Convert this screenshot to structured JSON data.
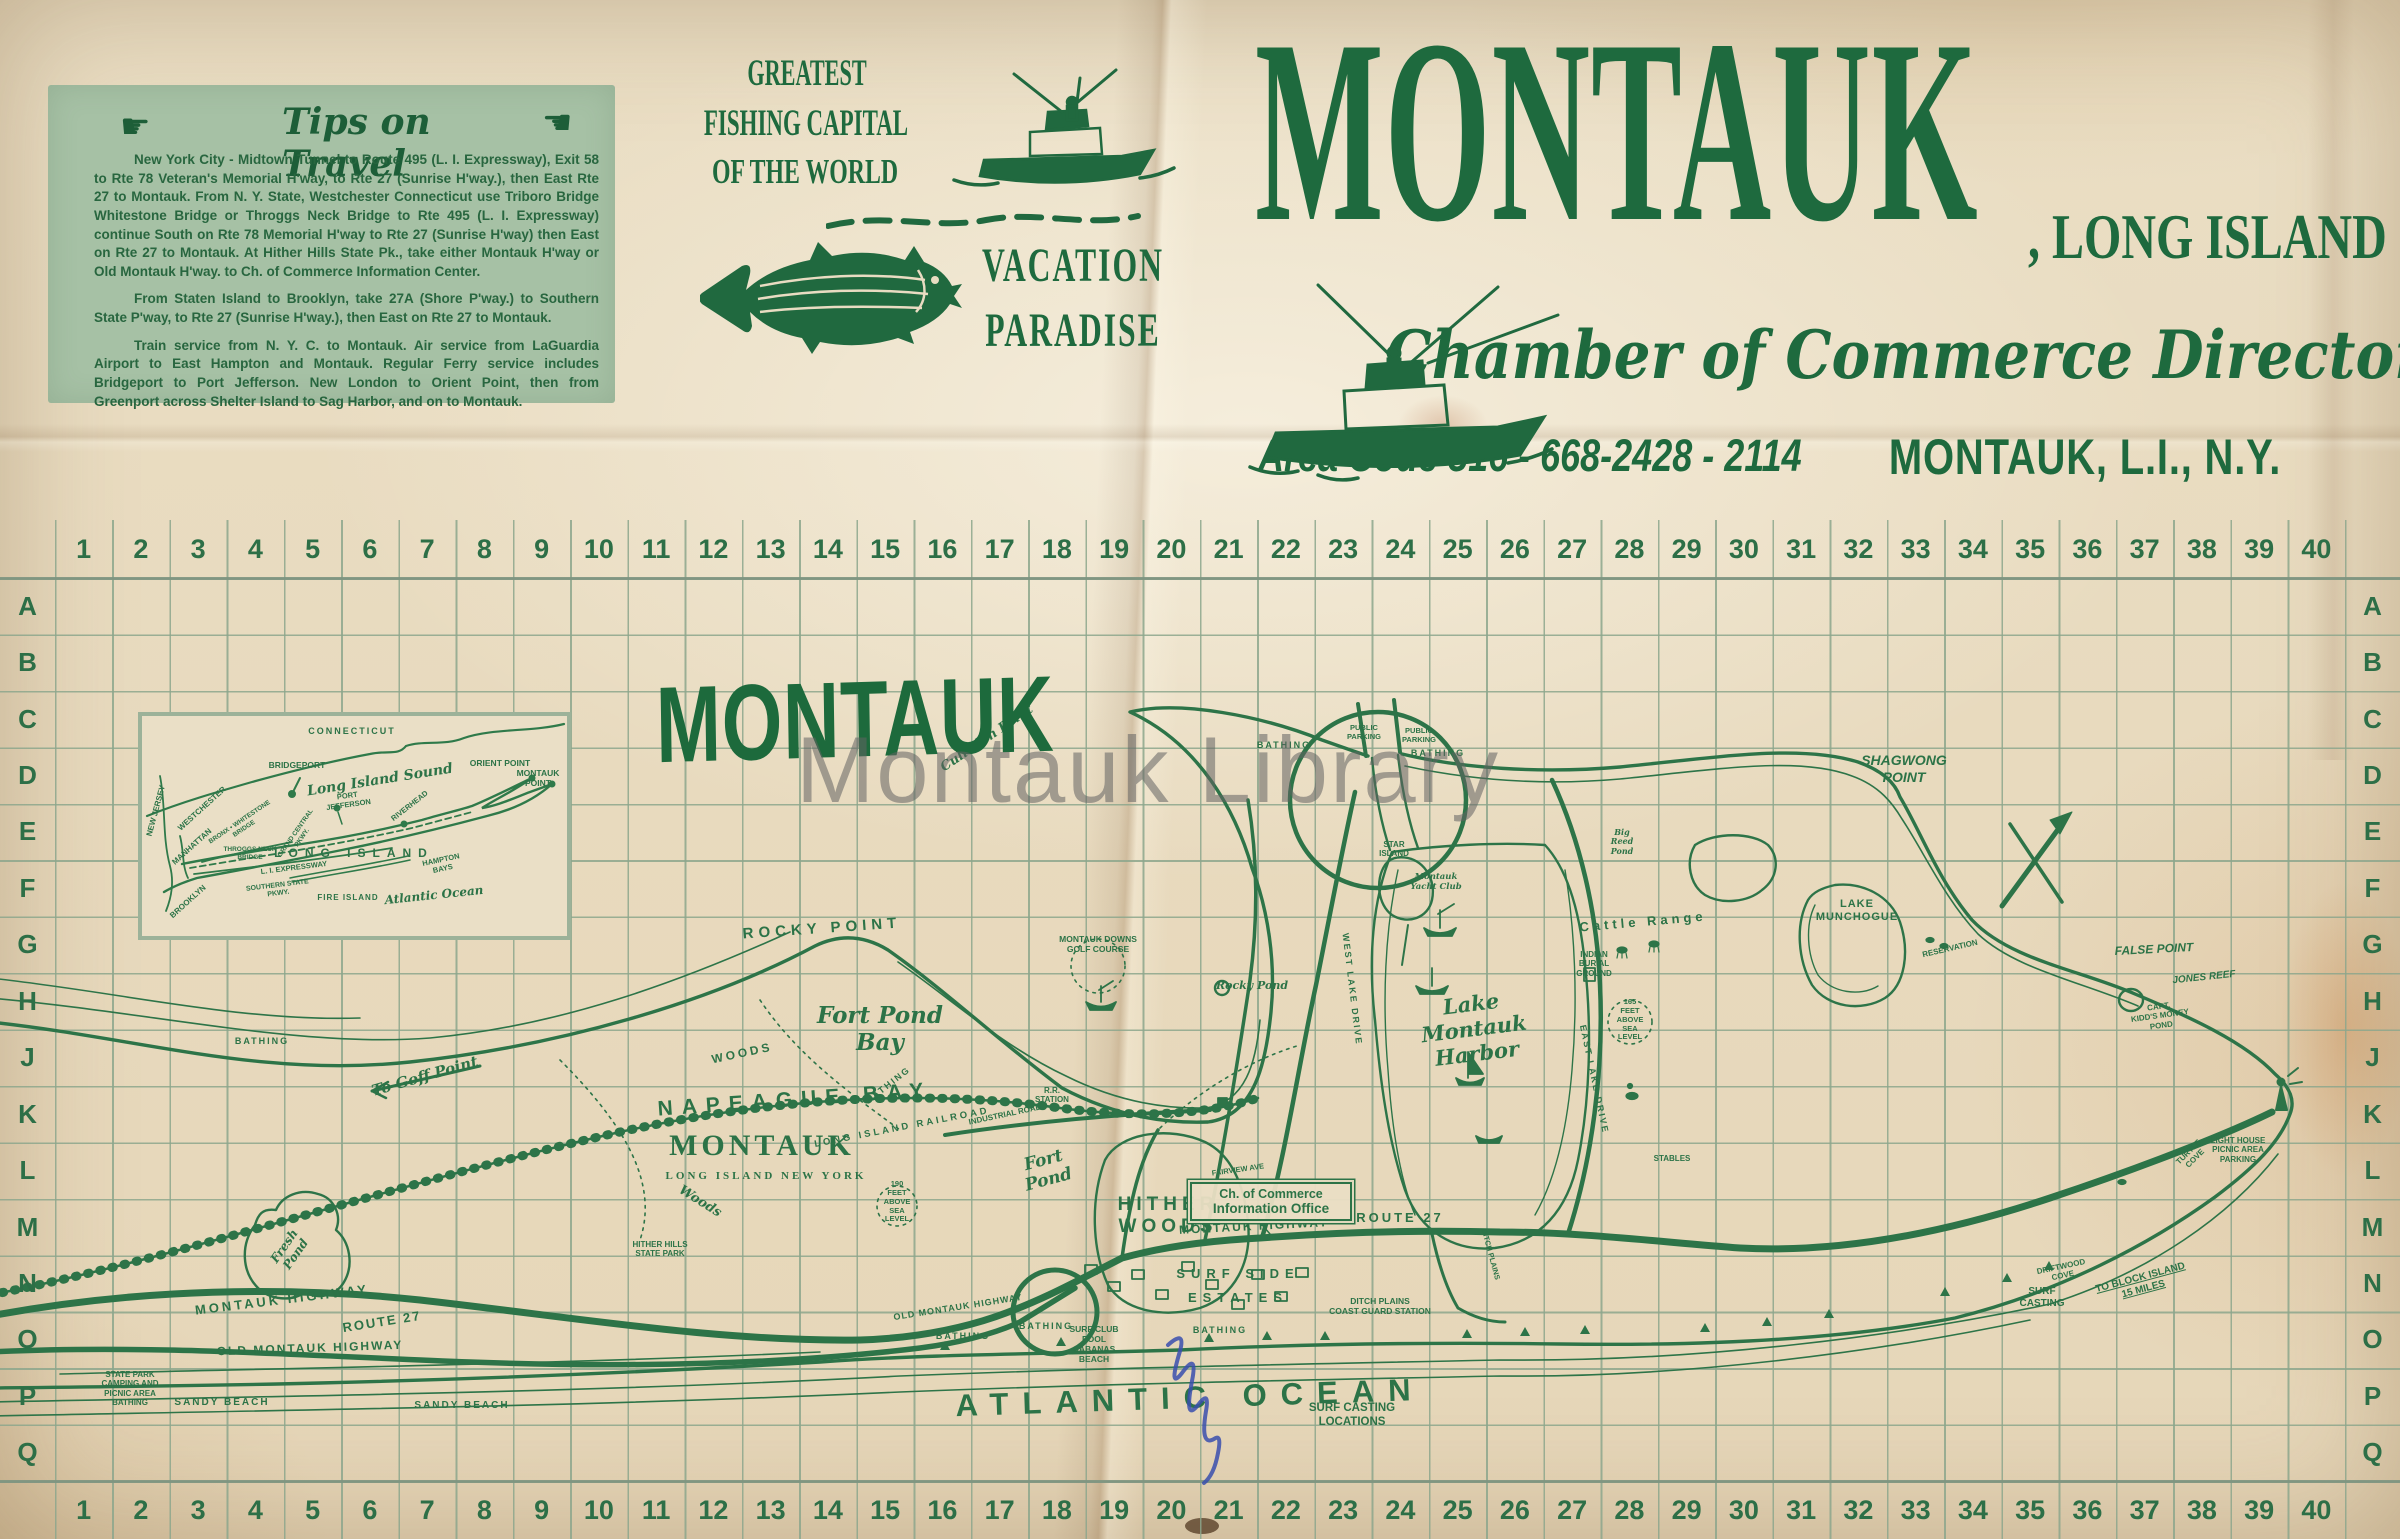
{
  "paper": {
    "watermark": "Montauk Library"
  },
  "tips_box": {
    "heading": "Tips on Travel",
    "hand_right": "☛",
    "hand_left": "☚",
    "paragraphs": [
      "New York City - Midtown Tunnel to Route 495 (L. I. Expressway), Exit 58 to Rte 78 Veteran's Memorial H'way, to Rte 27 (Sunrise H'way.), then East Rte 27 to Montauk. From N. Y. State, Westchester Connecticut use Triboro Bridge  Whitestone Bridge or Throggs Neck Bridge to Rte 495 (L. I. Expressway)  continue South on Rte 78 Memorial H'way to Rte 27 (Sunrise H'way) then East on Rte 27 to Montauk. At Hither Hills State Pk., take either Montauk H'way or Old Montauk H'way. to Ch. of Commerce Information Center.",
      "From Staten Island to Brooklyn, take 27A (Shore P'way.) to Southern State P'way, to Rte 27 (Sunrise H'way.), then East on Rte 27 to Montauk.",
      "Train service from N. Y. C. to Montauk. Air service from LaGuardia Airport to East Hampton and Montauk. Regular Ferry service includes Bridgeport to Port Jefferson. New London to Orient Point, then from Greenport across Shelter Island to Sag Harbor, and on to Montauk."
    ]
  },
  "banner": {
    "line1": "GREATEST",
    "line2": "FISHING CAPITAL",
    "line3": "OF THE WORLD",
    "vacation1": "VACATION",
    "vacation2": "PARADISE"
  },
  "masthead": {
    "title": "MONTAUK",
    "suffix": ", LONG ISLAND",
    "script_line": "Chamber of Commerce Directory",
    "location": "MONTAUK, L.I., N.Y.",
    "phone": "Area Code 516 - 668-2428 - 2114"
  },
  "grid": {
    "columns": [
      "1",
      "2",
      "3",
      "4",
      "5",
      "6",
      "7",
      "8",
      "9",
      "10",
      "11",
      "12",
      "13",
      "14",
      "15",
      "16",
      "17",
      "18",
      "19",
      "20",
      "21",
      "22",
      "23",
      "24",
      "25",
      "26",
      "27",
      "28",
      "29",
      "30",
      "31",
      "32",
      "33",
      "34",
      "35",
      "36",
      "37",
      "38",
      "39",
      "40"
    ],
    "rows": [
      "A",
      "B",
      "C",
      "D",
      "E",
      "F",
      "G",
      "H",
      "J",
      "K",
      "L",
      "M",
      "N",
      "O",
      "P",
      "Q"
    ]
  },
  "map": {
    "title": "MONTAUK",
    "office_line1": "Ch. of Commerce",
    "office_line2": "Information Office",
    "labels": [
      {
        "t": "NAPEAGUE BAY",
        "x": 795,
        "y": 1088,
        "fs": 21,
        "ls": 9,
        "rot": -4
      },
      {
        "t": "To Goff Point",
        "x": 425,
        "y": 1068,
        "fs": 15,
        "rot": -16,
        "cls": "script"
      },
      {
        "t": "Fresh\nPond",
        "x": 290,
        "y": 1236,
        "fs": 12,
        "rot": -55,
        "cls": "script"
      },
      {
        "t": "LONG ISLAND RAILROAD",
        "x": 902,
        "y": 1122,
        "fs": 9.5,
        "ls": 3,
        "rot": -11
      },
      {
        "t": "HITHER\nWOODS",
        "x": 1168,
        "y": 1194,
        "fs": 19,
        "ls": 5
      },
      {
        "t": "HITHER HILLS\nSTATE PARK",
        "x": 660,
        "y": 1240,
        "fs": 8
      },
      {
        "t": "ROCKY POINT",
        "x": 822,
        "y": 920,
        "fs": 15,
        "ls": 5,
        "rot": -4
      },
      {
        "t": "Rocky Pond",
        "x": 1252,
        "y": 980,
        "fs": 11,
        "cls": "script"
      },
      {
        "t": "Fort Pond\nBay",
        "x": 880,
        "y": 1002,
        "fs": 23,
        "cls": "script"
      },
      {
        "t": "WOODS",
        "x": 742,
        "y": 1046,
        "fs": 12,
        "ls": 3,
        "rot": -12
      },
      {
        "t": "Woods",
        "x": 700,
        "y": 1194,
        "fs": 13,
        "rot": 32,
        "cls": "script"
      },
      {
        "t": "MONTAUK HIGHWAY",
        "x": 282,
        "y": 1292,
        "fs": 13,
        "ls": 3,
        "rot": -7
      },
      {
        "t": "ROUTE 27",
        "x": 382,
        "y": 1314,
        "fs": 13,
        "ls": 2,
        "rot": -9
      },
      {
        "t": "OLD MONTAUK HIGHWAY",
        "x": 310,
        "y": 1341,
        "fs": 12,
        "ls": 2,
        "rot": -2
      },
      {
        "t": "OLD MONTAUK HIGHWAY",
        "x": 958,
        "y": 1302,
        "fs": 9,
        "ls": 1,
        "rot": -9
      },
      {
        "t": "STATE PARK\nCAMPING AND\nPICNIC AREA\nBATHING",
        "x": 130,
        "y": 1370,
        "fs": 8
      },
      {
        "t": "SANDY BEACH",
        "x": 222,
        "y": 1397,
        "fs": 10,
        "ls": 2
      },
      {
        "t": "SANDY BEACH",
        "x": 462,
        "y": 1400,
        "fs": 10,
        "ls": 2
      },
      {
        "t": "ATLANTIC OCEAN",
        "x": 1190,
        "y": 1380,
        "fs": 31,
        "ls": 14,
        "rot": -2
      },
      {
        "t": "BATHING",
        "x": 963,
        "y": 1331,
        "fs": 9,
        "ls": 2
      },
      {
        "t": "BATHING",
        "x": 1046,
        "y": 1321,
        "fs": 9,
        "ls": 2
      },
      {
        "t": "BATHING",
        "x": 1220,
        "y": 1325,
        "fs": 9,
        "ls": 2
      },
      {
        "t": "BATHING",
        "x": 888,
        "y": 1080,
        "fs": 9,
        "ls": 2,
        "rot": -38
      },
      {
        "t": "BATHING",
        "x": 1284,
        "y": 740,
        "fs": 9,
        "ls": 2
      },
      {
        "t": "BATHING",
        "x": 1438,
        "y": 748,
        "fs": 9,
        "ls": 2
      },
      {
        "t": "BATHING",
        "x": 262,
        "y": 1036,
        "fs": 9,
        "ls": 2
      },
      {
        "t": "SURF CLUB\nPOOL\nCABANAS\nBEACH",
        "x": 1094,
        "y": 1324,
        "fs": 8.5
      },
      {
        "t": "SURF SIDE",
        "x": 1238,
        "y": 1266,
        "fs": 13,
        "ls": 6
      },
      {
        "t": "ESTATES",
        "x": 1238,
        "y": 1290,
        "fs": 13,
        "ls": 6
      },
      {
        "t": "DITCH PLAINS\nCOAST GUARD STATION",
        "x": 1380,
        "y": 1296,
        "fs": 8.5
      },
      {
        "t": "SURF CASTING\nLOCATIONS",
        "x": 1352,
        "y": 1402,
        "fs": 11.5
      },
      {
        "t": "Fort\nPond",
        "x": 1046,
        "y": 1150,
        "fs": 17,
        "rot": -15,
        "cls": "script"
      },
      {
        "t": "Lake\nMontauk\nHarbor",
        "x": 1474,
        "y": 992,
        "fs": 21,
        "rot": -7,
        "cls": "script"
      },
      {
        "t": "Cattle Range",
        "x": 1643,
        "y": 914,
        "fs": 13,
        "ls": 4,
        "rot": -5
      },
      {
        "t": "INDIAN\nBURIAL\nGROUND",
        "x": 1594,
        "y": 950,
        "fs": 8
      },
      {
        "t": "165\nFEET\nABOVE\nSEA\nLEVEL",
        "x": 1630,
        "y": 998,
        "fs": 7.5
      },
      {
        "t": "190\nFEET\nABOVE\nSEA\nLEVEL",
        "x": 897,
        "y": 1180,
        "fs": 7.5
      },
      {
        "t": "STABLES",
        "x": 1672,
        "y": 1154,
        "fs": 8
      },
      {
        "t": "R.R.\n STATION",
        "x": 1052,
        "y": 1086,
        "fs": 8
      },
      {
        "t": "STAR\nISLAND",
        "x": 1394,
        "y": 840,
        "fs": 8
      },
      {
        "t": "Montauk\nYacht Club",
        "x": 1436,
        "y": 872,
        "fs": 8.5,
        "cls": "script"
      },
      {
        "t": "PUBLIC\nPARKING",
        "x": 1364,
        "y": 724,
        "fs": 7.5
      },
      {
        "t": "PUBLIC\nPARKING",
        "x": 1419,
        "y": 727,
        "fs": 7.5
      },
      {
        "t": "Culloden Point",
        "x": 987,
        "y": 731,
        "fs": 13,
        "rot": -34,
        "cls": "script"
      },
      {
        "t": "SHAGWONG\nPOINT",
        "x": 1904,
        "y": 752,
        "fs": 14,
        "cls": "it"
      },
      {
        "t": "LAKE\nMUNCHOGUE",
        "x": 1857,
        "y": 898,
        "fs": 11,
        "ls": 1
      },
      {
        "t": "RESERVATION",
        "x": 1950,
        "y": 944,
        "fs": 8,
        "rot": -13
      },
      {
        "t": "FALSE POINT",
        "x": 2154,
        "y": 942,
        "fs": 12,
        "rot": -3,
        "cls": "it"
      },
      {
        "t": "JONES REEF",
        "x": 2204,
        "y": 972,
        "fs": 10,
        "rot": -6,
        "cls": "it"
      },
      {
        "t": "CAPT.\nKIDD'S MONEY\nPOND",
        "x": 2160,
        "y": 1002,
        "fs": 8,
        "rot": -8
      },
      {
        "t": "LIGHT HOUSE\nPICNIC AREA\nPARKING",
        "x": 2238,
        "y": 1136,
        "fs": 8
      },
      {
        "t": "TURTLE\nCOVE",
        "x": 2192,
        "y": 1146,
        "fs": 8,
        "rot": -45
      },
      {
        "t": "DRIFTWOOD\nCOVE",
        "x": 2062,
        "y": 1262,
        "fs": 8,
        "rot": -12
      },
      {
        "t": "SURF\nCASTING",
        "x": 2042,
        "y": 1286,
        "fs": 10
      },
      {
        "t": "TO BLOCK ISLAND\n15 MILES",
        "x": 2142,
        "y": 1272,
        "fs": 10,
        "rot": -15,
        "u": 1
      },
      {
        "t": "EAST LAKE DRIVE",
        "x": 1594,
        "y": 1074,
        "fs": 9,
        "ls": 2,
        "rot": 78
      },
      {
        "t": "WEST LAKE DRIVE",
        "x": 1352,
        "y": 984,
        "fs": 9,
        "ls": 2,
        "rot": 83
      },
      {
        "t": "Big\nReed\nPond",
        "x": 1622,
        "y": 828,
        "fs": 8,
        "cls": "script"
      },
      {
        "t": "MONTAUK DOWNS\nGOLF COURSE",
        "x": 1098,
        "y": 934,
        "fs": 8.5
      },
      {
        "t": "MONTAUK HIGHWAY",
        "x": 1254,
        "y": 1219,
        "fs": 12,
        "ls": 2,
        "rot": -3
      },
      {
        "t": "ROUTE 27",
        "x": 1400,
        "y": 1210,
        "fs": 13,
        "ls": 3
      },
      {
        "t": "FAIRVIEW AVE",
        "x": 1238,
        "y": 1166,
        "fs": 7.5,
        "rot": -8
      },
      {
        "t": "DITCH PLAINS",
        "x": 1490,
        "y": 1250,
        "fs": 7.5,
        "rot": 75
      },
      {
        "t": "INDUSTRIAL ROAD",
        "x": 1005,
        "y": 1110,
        "fs": 8,
        "rot": -12
      },
      {
        "t": "MONTAUK",
        "x": 762,
        "y": 1128,
        "fs": 30,
        "ls": 4,
        "cls": "ser"
      },
      {
        "t": "LONG ISLAND      NEW YORK",
        "x": 766,
        "y": 1170,
        "fs": 11,
        "ls": 3,
        "cls": "ser"
      }
    ]
  },
  "inset": {
    "labels": [
      {
        "t": "CONNECTICUT",
        "x": 210,
        "y": 10,
        "fs": 9,
        "ls": 2
      },
      {
        "t": "BRIDGEPORT",
        "x": 155,
        "y": 44,
        "fs": 8.5
      },
      {
        "t": "Long Island Sound",
        "x": 238,
        "y": 56,
        "fs": 14,
        "rot": -9,
        "cls": "script"
      },
      {
        "t": "ORIENT POINT",
        "x": 358,
        "y": 42,
        "fs": 8.5
      },
      {
        "t": "MONTAUK\nPOINT",
        "x": 396,
        "y": 52,
        "fs": 8.5
      },
      {
        "t": "NEW JERSEY",
        "x": 14,
        "y": 90,
        "fs": 8,
        "rot": -75
      },
      {
        "t": "WESTCHESTER",
        "x": 60,
        "y": 88,
        "fs": 8,
        "rot": -42
      },
      {
        "t": "BRONX • WHITESTONE\nBRIDGE",
        "x": 100,
        "y": 102,
        "fs": 6.5,
        "rot": -34
      },
      {
        "t": "MANHATTAN",
        "x": 50,
        "y": 126,
        "fs": 8,
        "rot": -42
      },
      {
        "t": "THROGGS NECK\nBRIDGE",
        "x": 108,
        "y": 130,
        "fs": 6.5
      },
      {
        "t": "L. I. EXPRESSWAY",
        "x": 152,
        "y": 148,
        "fs": 7.5,
        "rot": -7
      },
      {
        "t": "GRAND CENTRAL\nPKWY.",
        "x": 157,
        "y": 112,
        "fs": 6.5,
        "rot": -55
      },
      {
        "t": "PORT\nJEFFERSON",
        "x": 206,
        "y": 76,
        "fs": 7.5,
        "rot": -8
      },
      {
        "t": "RIVERHEAD",
        "x": 268,
        "y": 86,
        "fs": 7.5,
        "rot": -38
      },
      {
        "t": "LONG ISLAND",
        "x": 212,
        "y": 130,
        "fs": 12,
        "ls": 7
      },
      {
        "t": "HAMPTON\nBAYS",
        "x": 300,
        "y": 140,
        "fs": 7.5,
        "rot": -12
      },
      {
        "t": "SOUTHERN STATE\nPKWY.",
        "x": 136,
        "y": 166,
        "fs": 7,
        "rot": -7
      },
      {
        "t": "FIRE ISLAND",
        "x": 206,
        "y": 177,
        "fs": 8,
        "ls": 1
      },
      {
        "t": "Atlantic Ocean",
        "x": 292,
        "y": 172,
        "fs": 12,
        "rot": -6,
        "cls": "script"
      },
      {
        "t": "BROOKLYN",
        "x": 46,
        "y": 181,
        "fs": 8,
        "rot": -42
      }
    ]
  }
}
